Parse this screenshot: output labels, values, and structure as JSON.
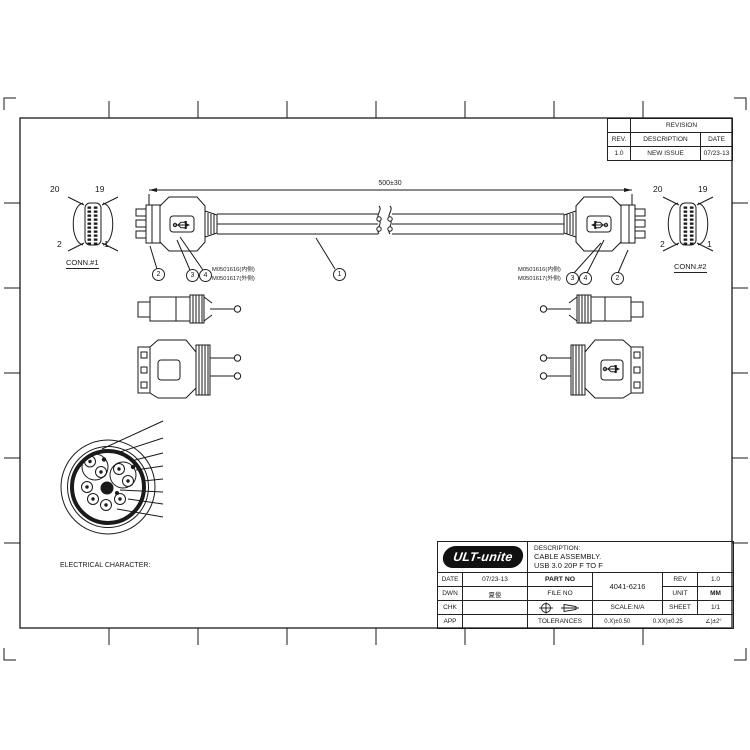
{
  "sheet": {
    "bg": "#ffffff",
    "line_color": "#1a1a1a"
  },
  "frame": {
    "top_zones": [
      "1",
      "2",
      "3",
      "4",
      "5",
      "6",
      "7",
      "8"
    ],
    "bottom_zones": [
      "1",
      "2",
      "3",
      "4",
      "5",
      "6",
      "7",
      "8"
    ],
    "left_zones": [
      "A",
      "B",
      "C",
      "D",
      "E",
      "F"
    ],
    "right_zones": [
      "A",
      "B",
      "C",
      "D",
      "E",
      "F"
    ]
  },
  "revision_table": {
    "title": "REVISION",
    "headers": [
      "REV.",
      "DESCRIPTION",
      "DATE"
    ],
    "rows": [
      [
        "1.0",
        "NEW ISSUE",
        "07/23-13"
      ]
    ]
  },
  "assembly": {
    "dimension": "500±30",
    "conn1": {
      "label": "CONN.#1",
      "pin_tl": "20",
      "pin_tr": "19",
      "pin_bl": "2",
      "pin_br": "1"
    },
    "conn2": {
      "label": "CONN.#2",
      "pin_tl": "20",
      "pin_tr": "19",
      "pin_bl": "2",
      "pin_br": "1"
    },
    "balloon_1": "1",
    "balloon_2": "2",
    "balloon_3": "3",
    "balloon_4": "4",
    "left_note_line1": "M0501616(内侧)",
    "left_note_line2": "M0501617(外侧)",
    "right_note_line1": "M0501616(内侧)",
    "right_note_line2": "M0501617(外侧)"
  },
  "wire_diagram": {
    "title": "WIRE DIAGRAM",
    "conn1_label": "CONN.#1",
    "conn2_label": "CONN.#2",
    "groups": [
      {
        "type": "straight",
        "wires": [
          {
            "pin_left": "1",
            "color": "RED",
            "pin_right": "1"
          },
          {
            "pin_left": "15",
            "color": "WHITE",
            "pin_right": "15"
          },
          {
            "pin_left": "17",
            "color": "GREEN",
            "pin_right": "17"
          },
          {
            "pin_left": "13",
            "color": "BLACK",
            "pin_right": "13"
          }
        ]
      },
      {
        "type": "twisted_pair",
        "wires": [
          {
            "pin_left": "3",
            "color": "BLUE",
            "pin_right": "3"
          },
          {
            "pin_left": "5",
            "color": "YELLOW",
            "pin_right": "5"
          }
        ],
        "drain": {
          "pin_left": "7",
          "label": "DRAIN",
          "pin_right": "7"
        }
      },
      {
        "type": "twisted_pair",
        "wires": [
          {
            "pin_left": "9",
            "color": "PURPLE",
            "pin_right": "9"
          },
          {
            "pin_left": "11",
            "color": "ORANGE",
            "pin_right": "11"
          }
        ],
        "drain": {
          "pin_left": "19",
          "label": "DRAIN",
          "pin_right": "19"
        }
      },
      {
        "type": "straight",
        "wires": [
          {
            "pin_left": "4",
            "color": "RED",
            "pin_right": "4"
          },
          {
            "pin_left": "18",
            "color": "WHITE",
            "pin_right": "18"
          },
          {
            "pin_left": "20",
            "color": "GREEN",
            "pin_right": "20"
          },
          {
            "pin_left": "16",
            "color": "BLACK",
            "pin_right": "16"
          }
        ]
      },
      {
        "type": "twisted_pair",
        "wires": [
          {
            "pin_left": "6",
            "color": "BLUE",
            "pin_right": "6"
          },
          {
            "pin_left": "8",
            "color": "YELLOW",
            "pin_right": "8"
          }
        ],
        "drain": {
          "pin_left": "10",
          "label": "DRAIN",
          "pin_right": "10"
        }
      },
      {
        "type": "twisted_pair",
        "wires": [
          {
            "pin_left": "12",
            "color": "PURPLE",
            "pin_right": "12"
          },
          {
            "pin_left": "14",
            "color": "ORANGE",
            "pin_right": "14"
          }
        ],
        "drain": {
          "pin_left": "19",
          "label": "DRAIN",
          "pin_right": "19"
        }
      }
    ]
  },
  "cross_section": {
    "labels": [
      "DRAIN",
      "JACKET",
      "BRAID",
      "AL/MY",
      "TRANSPARENT",
      "FILLER",
      "DRAIN",
      "CONDUCTOR"
    ]
  },
  "electrical_notes": {
    "title": "ELECTRICAL CHARACTER:",
    "items": [
      "1. 100% OPEN&SHORT TESTING",
      "2. WITHSTANDING VOLTAGE:DC 300V 0.1Sec",
      "3. INSULATION RESISTANCE:20M Ohms(Min)",
      "4. CONDUCTIVE RESISTANCE:1.0 Ohms(Max)"
    ]
  },
  "bom": {
    "headers": [
      "NO.",
      "DESCRIPTION",
      "QTY.",
      "PART NO.",
      "MATERAL"
    ],
    "rows": [
      [
        "4",
        "OVERMOLD",
        "15.2g",
        "YL0103014",
        "PVC 45P BLUE UL94V-0"
      ],
      [
        "3",
        "INNERMOLD",
        "3.6g",
        "YL0103013",
        "PE LOW DENSITY"
      ],
      [
        "2",
        "CONN.",
        "2",
        "YL0102037",
        "USB3.0 20P 内接式插头, 蓝色胶芯"
      ],
      [
        "1",
        "USB3.0 CABLE",
        "1000mm",
        "YL0101034",
        "(7/0.127T*1P+D(7/0.127T)+AL+M)*2+7/0.127T*1P+7/0.20T*2C+FAD(7/0.127B)B(16/6/0.12 AL.M)OD:6.0mm PVC BLUE"
      ]
    ]
  },
  "title_block": {
    "logo": "ULT-unite",
    "desc_label": "DESCRIPTION:",
    "desc_line1": "CABLE ASSEMBLY.",
    "desc_line2": "USB 3.0 20P F  TO F",
    "date_label": "DATE",
    "date_value": "07/23-13",
    "part_no_label": "PART NO",
    "part_no_value": "4041-6216",
    "rev_label": "REV",
    "rev_value": "1.0",
    "dwn_label": "DWN",
    "dwn_value": "夏俊",
    "file_no_label": "FILE NO",
    "unit_label": "UNIT",
    "unit_value": "MM",
    "chk_label": "CHK",
    "scale_label": "SCALE:N/A",
    "sheet_label": "SHEET",
    "sheet_value": "1/1",
    "app_label": "APP",
    "tolerances_label": "TOLERANCES",
    "tol_1": "0.X)±0.50",
    "tol_2": "0.XX)±0.25",
    "tol_3": "∠)±2°"
  }
}
